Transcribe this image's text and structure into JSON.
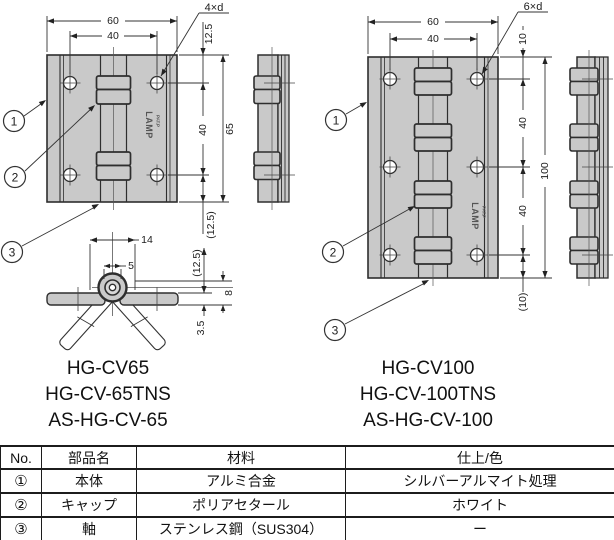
{
  "brand": {
    "logo": "LAMP",
    "patent": "PAT.P"
  },
  "colors": {
    "metal": "#c9c9c9",
    "line": "#2e2e2e",
    "text": "#1a1a1a"
  },
  "refs": {
    "r1": "1",
    "r2": "2",
    "r3": "3"
  },
  "left_view": {
    "dims": {
      "width": "60",
      "hole_pitch_x": "40",
      "hole_callout": "4×d",
      "edge_top": "12.5",
      "hole_pitch_y": "40",
      "height": "65",
      "edge_bottom": "(12.5)"
    },
    "models": [
      "HG-CV65",
      "HG-CV-65TNS",
      "AS-HG-CV-65"
    ]
  },
  "section_view": {
    "dims": {
      "cap_width": "14",
      "pin_width": "5",
      "height_ref": "(12.5)",
      "knuckle_height": "8",
      "plate_thickness": "3.5"
    }
  },
  "right_view": {
    "dims": {
      "width": "60",
      "hole_pitch_x": "40",
      "hole_callout": "6×d",
      "edge_top": "10",
      "pitch_a": "40",
      "height": "100",
      "pitch_b": "40",
      "edge_bottom": "(10)"
    },
    "models": [
      "HG-CV100",
      "HG-CV-100TNS",
      "AS-HG-CV-100"
    ]
  },
  "table": {
    "headers": [
      "No.",
      "部品名",
      "材料",
      "仕上/色"
    ],
    "rows": [
      [
        "①",
        "本体",
        "アルミ合金",
        "シルバーアルマイト処理"
      ],
      [
        "②",
        "キャップ",
        "ポリアセタール",
        "ホワイト"
      ],
      [
        "③",
        "軸",
        "ステンレス鋼（SUS304）",
        "ー"
      ]
    ]
  }
}
